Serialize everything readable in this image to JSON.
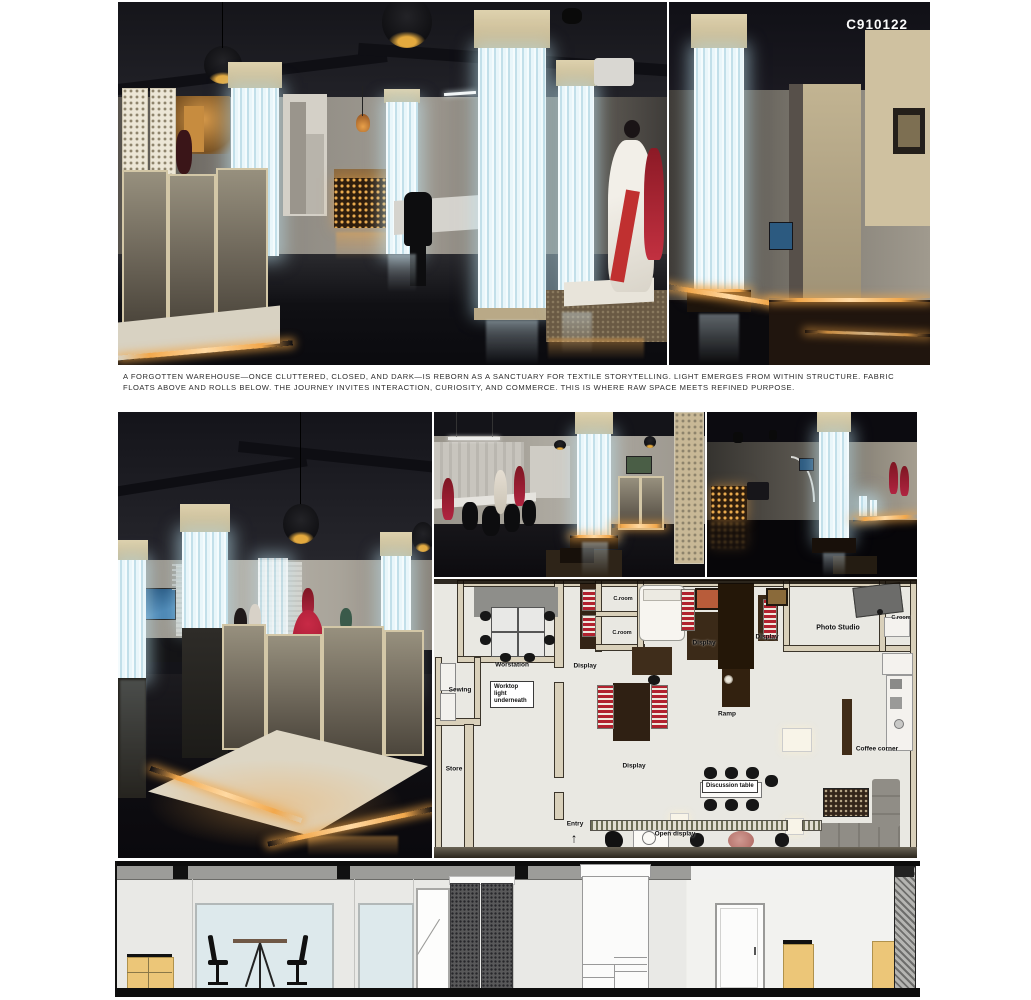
{
  "board": {
    "code": "C910122"
  },
  "caption": {
    "lines": [
      "A FORGOTTEN WAREHOUSE—ONCE CLUTTERED, CLOSED, AND DARK—IS REBORN AS A SANCTUARY FOR TEXTILE STORYTELLING. LIGHT EMERGES FROM WITHIN STRUCTURE. FABRIC",
      "FLOATS ABOVE AND ROLLS BELOW. THE JOURNEY INVITES INTERACTION, CURIOSITY, AND COMMERCE. THIS IS WHERE RAW SPACE MEETS REFINED PURPOSE."
    ]
  },
  "floor_plan": {
    "entry_arrow": "↑",
    "labels": [
      {
        "text": "Worstation"
      },
      {
        "text": "Display"
      },
      {
        "text": "C.room"
      },
      {
        "text": "C.room"
      },
      {
        "text": "Display"
      },
      {
        "text": "Display"
      },
      {
        "text": "Photo Studio"
      },
      {
        "text": "C.room"
      },
      {
        "text": "Sewing"
      },
      {
        "text": "Worktop light underneath"
      },
      {
        "text": "Store"
      },
      {
        "text": "Ramp"
      },
      {
        "text": "Coffee corner"
      },
      {
        "text": "Display"
      },
      {
        "text": "Discussion table"
      },
      {
        "text": "Entry"
      },
      {
        "text": "Open display"
      }
    ]
  },
  "palette": {
    "warm_accent": "#E89B3F",
    "light_column": "#D9EEF5",
    "plan_brown": "#332414",
    "red_display": "#B02430",
    "wood_tan": "#ECC678"
  }
}
